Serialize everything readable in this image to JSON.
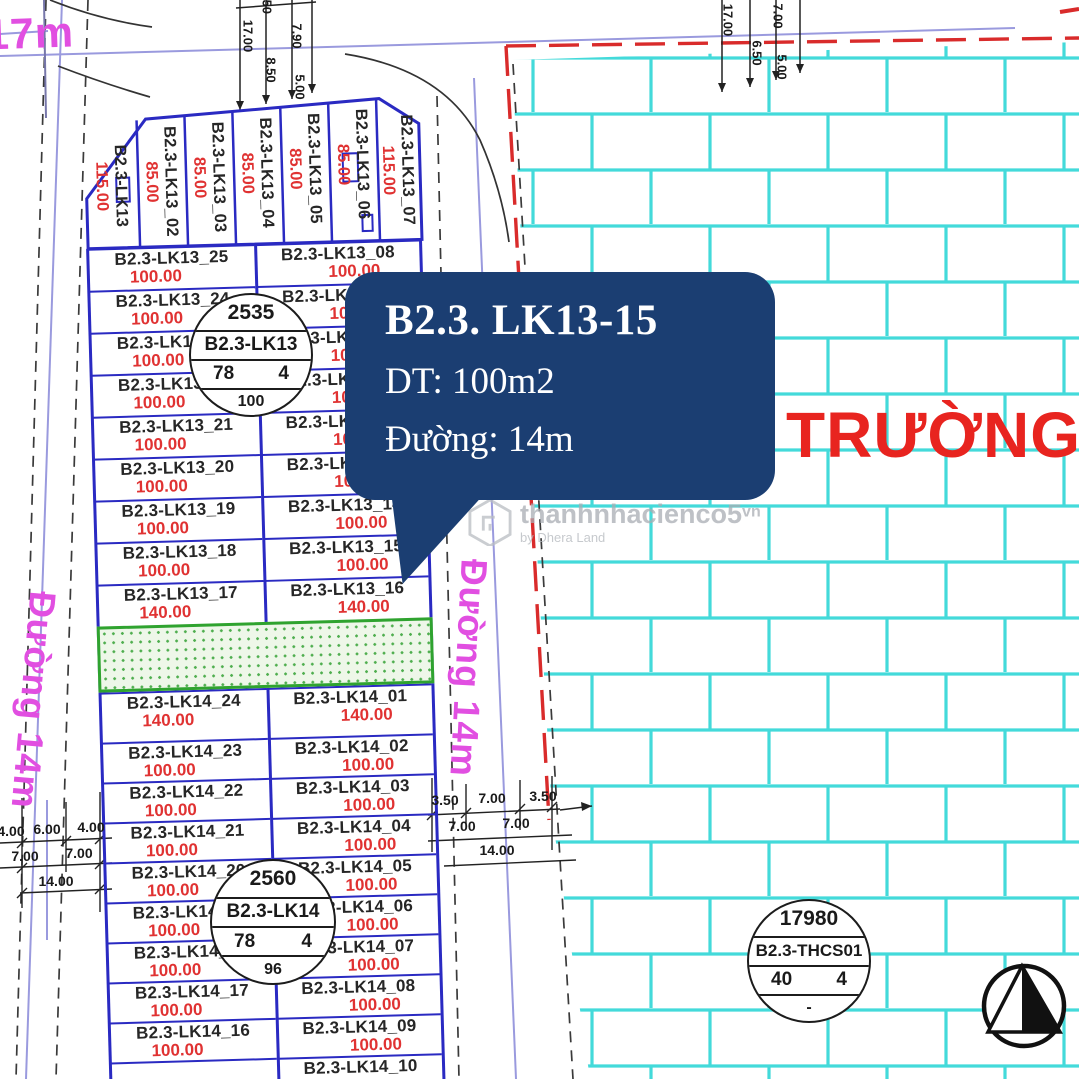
{
  "colors": {
    "plot_blue": "#2a2ac2",
    "area_red": "#e03232",
    "road_magenta": "#e14fe1",
    "school_red": "#e8241f",
    "brick_cyan": "#43dada",
    "tooltip_navy": "#1b3e72",
    "green_border": "#2fa32f",
    "boundary_red_dash": "#d92b2b"
  },
  "roads": {
    "top_left_road_label": "17m",
    "left_road_label": "Đường 14m",
    "middle_road_label": "Đường 14m"
  },
  "school": {
    "name": "TRƯỜNG T"
  },
  "tooltip": {
    "title": "B2.3. LK13-15",
    "area_line": "DT: 100m2",
    "road_line": "Đường: 14m"
  },
  "watermark": {
    "brand": "thanhnhacienco5",
    "domain": "vn",
    "byline": "by Dhera Land"
  },
  "circles": {
    "lk13": {
      "top": "2535",
      "name": "B2.3-LK13",
      "left": "78",
      "right": "4",
      "bottom": "100"
    },
    "lk14": {
      "top": "2560",
      "name": "B2.3-LK14",
      "left": "78",
      "right": "4",
      "bottom": "96"
    },
    "thcs": {
      "top": "17980",
      "name": "B2.3-THCS01",
      "left": "40",
      "right": "4",
      "bottom": "-"
    }
  },
  "plots": {
    "lk13_top": [
      {
        "label": "B2.3-LK13",
        "area": "115.00"
      },
      {
        "label": "B2.3-LK13_02",
        "area": "85.00"
      },
      {
        "label": "B2.3-LK13_03",
        "area": "85.00"
      },
      {
        "label": "B2.3-LK13_04",
        "area": "85.00"
      },
      {
        "label": "B2.3-LK13_05",
        "area": "85.00"
      },
      {
        "label": "B2.3-LK13_06",
        "area": "85.00"
      },
      {
        "label": "B2.3-LK13_07",
        "area": "115.00"
      }
    ],
    "lk13_left": [
      {
        "label": "B2.3-LK13_25",
        "area": "100.00"
      },
      {
        "label": "B2.3-LK13_24",
        "area": "100.00"
      },
      {
        "label": "B2.3-LK13_23",
        "area": "100.00"
      },
      {
        "label": "B2.3-LK13_22",
        "area": "100.00"
      },
      {
        "label": "B2.3-LK13_21",
        "area": "100.00"
      },
      {
        "label": "B2.3-LK13_20",
        "area": "100.00"
      },
      {
        "label": "B2.3-LK13_19",
        "area": "100.00"
      },
      {
        "label": "B2.3-LK13_18",
        "area": "100.00"
      },
      {
        "label": "B2.3-LK13_17",
        "area": "140.00"
      }
    ],
    "lk13_right": [
      {
        "label": "B2.3-LK13_08",
        "area": "100.00"
      },
      {
        "label": "B2.3-LK13_09",
        "area": "100.00"
      },
      {
        "label": "B2.3-LK13_10",
        "area": "100.00"
      },
      {
        "label": "B2.3-LK13_11",
        "area": "100.00"
      },
      {
        "label": "B2.3-LK13_12",
        "area": "100.00"
      },
      {
        "label": "B2.3-LK13_13",
        "area": "100.00"
      },
      {
        "label": "B2.3-LK13_14",
        "area": "100.00"
      },
      {
        "label": "B2.3-LK13_15",
        "area": "100.00"
      },
      {
        "label": "B2.3-LK13_16",
        "area": "140.00"
      }
    ],
    "lk14_left": [
      {
        "label": "B2.3-LK14_24",
        "area": "140.00"
      },
      {
        "label": "B2.3-LK14_23",
        "area": "100.00"
      },
      {
        "label": "B2.3-LK14_22",
        "area": "100.00"
      },
      {
        "label": "B2.3-LK14_21",
        "area": "100.00"
      },
      {
        "label": "B2.3-LK14_20",
        "area": "100.00"
      },
      {
        "label": "B2.3-LK14_19",
        "area": "100.00"
      },
      {
        "label": "B2.3-LK14_18",
        "area": "100.00"
      },
      {
        "label": "B2.3-LK14_17",
        "area": "100.00"
      },
      {
        "label": "B2.3-LK14_16",
        "area": "100.00"
      },
      {
        "label": "",
        "area": ""
      }
    ],
    "lk14_right": [
      {
        "label": "B2.3-LK14_01",
        "area": "140.00"
      },
      {
        "label": "B2.3-LK14_02",
        "area": "100.00"
      },
      {
        "label": "B2.3-LK14_03",
        "area": "100.00"
      },
      {
        "label": "B2.3-LK14_04",
        "area": "100.00"
      },
      {
        "label": "B2.3-LK14_05",
        "area": "100.00"
      },
      {
        "label": "B2.3-LK14_06",
        "area": "100.00"
      },
      {
        "label": "B2.3-LK14_07",
        "area": "100.00"
      },
      {
        "label": "B2.3-LK14_08",
        "area": "100.00"
      },
      {
        "label": "B2.3-LK14_09",
        "area": "100.00"
      },
      {
        "label": "B2.3-LK14_10",
        "area": ""
      }
    ]
  },
  "dimensions": {
    "top_left": [
      "17.00",
      "7.90",
      "8.50",
      "5.00",
      ".50"
    ],
    "top_right": [
      "17.00",
      "7.00",
      "6.50",
      "5.00"
    ],
    "bottom_left_rows": [
      [
        "4.00",
        "6.00",
        "4.00"
      ],
      [
        "7.00",
        "7.00"
      ],
      [
        "14.00"
      ]
    ],
    "middle_rows": [
      [
        "3.50",
        "7.00",
        "3.50"
      ],
      [
        "7.00",
        "7.00"
      ],
      [
        "14.00"
      ]
    ]
  }
}
